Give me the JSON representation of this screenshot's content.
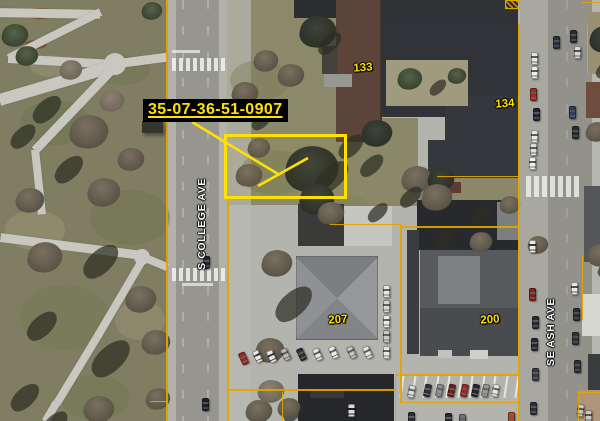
{
  "annotation": {
    "parcel_id": "35-07-36-51-0907"
  },
  "streets": [
    {
      "name": "S COLLEGE AVE"
    },
    {
      "name": "SE ASH AVE"
    }
  ],
  "parcels": [
    {
      "number": "133"
    },
    {
      "number": "134"
    },
    {
      "number": "207"
    },
    {
      "number": "200"
    }
  ],
  "colors": {
    "highlight": "#FFE100",
    "parcel-line": "#E2A400",
    "label-bg": "#000000",
    "label-text": "#FFE100",
    "street-label": "#FFFFFF",
    "parcel-number": "#FFE100"
  }
}
